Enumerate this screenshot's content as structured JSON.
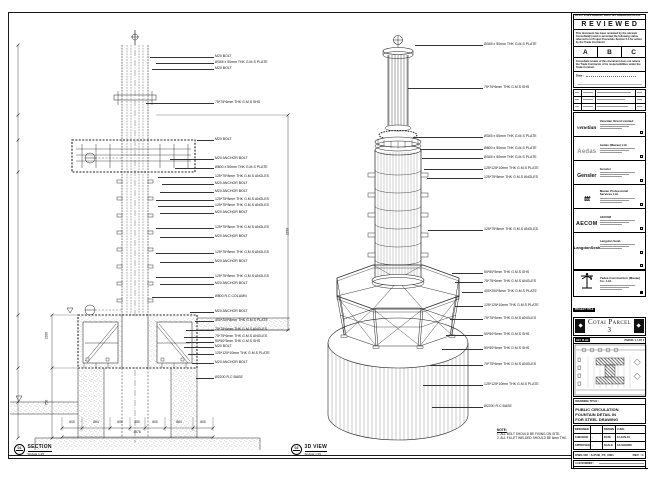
{
  "stamp": {
    "strip": "DO NOT SCALE DRAWING. VERIFY ALL DIMENSIONS ON SITE.",
    "title": "REVIEWED",
    "para1": "This document has been reviewed by the relevant Consultant(s) and is accorded the following status referred to in Project Procedure Section 5.4 for action by the Trade Contractor.",
    "options": [
      "A",
      "B",
      "C"
    ],
    "para2": "Consultant review of this document does not relieve the Trade Contractor of its responsibilities under the Trade Contract.",
    "date_label": "Date :"
  },
  "consultants": [
    {
      "logo": "venetian",
      "cls": "lg-ven",
      "name": "Venetian Orient Limited"
    },
    {
      "logo": "Aedas",
      "cls": "lg-aedas",
      "name": "Aedas (Macau) Ltd."
    },
    {
      "logo": "Gensler",
      "cls": "lg-gensler",
      "name": "Gensler"
    },
    {
      "logo": "ttt",
      "cls": "lg-ttt",
      "name": "Macau Professional Services Ltd."
    },
    {
      "logo": "AECOM",
      "cls": "lg-aecom",
      "name": "AECOM"
    },
    {
      "logo": "LangdonSeah",
      "cls": "lg-ls",
      "name": "Langdon Seah"
    }
  ],
  "contractor": {
    "name": "Yadea Construction (Macau) Co., Ltd."
  },
  "project": {
    "tag": "PROJECT TITLE",
    "title": "Cotai Parcel 3"
  },
  "key_plan": {
    "label": "KEY PLAN",
    "sub": "PARCEL 1, LOT 2"
  },
  "drawing_title": {
    "label": "DRAWING TITLE :",
    "lines": [
      "PUBLIC CIRCULATION",
      "FOUNTAIN DETAIL IN",
      "FOR STEEL DRAWING"
    ]
  },
  "fields": {
    "rows": [
      {
        "a": "DESIGNED",
        "b": "",
        "c": "DRAWN",
        "d": "LUNG"
      },
      {
        "a": "CHECKED",
        "b": "-",
        "c": "DATE",
        "d": "14-JAN-10"
      },
      {
        "a": "APPROVED",
        "b": "-",
        "c": "SCALE",
        "d": "AS SHOWN"
      }
    ]
  },
  "dwg": {
    "label": "DWG NO :",
    "value": "S-PUB_FS_0001",
    "rev_label": "REV :",
    "rev": "C"
  },
  "cad_rows": [
    {
      "l": "CAD NUMBER :",
      "v": ""
    },
    {
      "l": "CAD FILE NAME :",
      "v": "S-PUB_FS_0001.dwg"
    },
    {
      "l": "REFERENCE :",
      "v": ""
    }
  ],
  "notes": {
    "title": "NOTE:",
    "items": [
      "1. ALL BOLT SHOULD BE FIXING ON SITE.",
      "2. ALL FILLET WELDED SHOULD BE 6mm THK."
    ]
  },
  "views": [
    {
      "num": "01",
      "name": "SECTION",
      "scale": "SCALE 1:25",
      "x": 14,
      "y": 444
    },
    {
      "num": "02",
      "name": "3D VIEW",
      "scale": "SCALE 1:25",
      "x": 291,
      "y": 444
    }
  ],
  "section_labels": [
    {
      "t": "M20 BOLT",
      "x": 214,
      "y": 57,
      "a": 150
    },
    {
      "t": "Ø345 x 50mm THK G.M.S PLATE",
      "x": 214,
      "y": 63,
      "a": 156
    },
    {
      "t": "M20 BOLT",
      "x": 214,
      "y": 69,
      "a": 152
    },
    {
      "t": "75*75*6mm THK G.M.S SHS",
      "x": 214,
      "y": 103,
      "a": 146
    },
    {
      "t": "M20 BOLT",
      "x": 214,
      "y": 140,
      "a": 197
    },
    {
      "t": "M20 ANCHOR BOLT",
      "x": 214,
      "y": 159,
      "a": 170
    },
    {
      "t": "Ø800 x 50mm THK G.M.S PLATE",
      "x": 214,
      "y": 168,
      "a": 175
    },
    {
      "t": "125*75*8mm THK G.M.S ANGLES",
      "x": 214,
      "y": 177,
      "a": 158
    },
    {
      "t": "M20 ANCHOR BOLT",
      "x": 214,
      "y": 184,
      "a": 162
    },
    {
      "t": "M20 ANCHOR BOLT",
      "x": 214,
      "y": 192,
      "a": 160
    },
    {
      "t": "125*75*8mm THK G.M.S ANGLES",
      "x": 214,
      "y": 200,
      "a": 156
    },
    {
      "t": "125*75*8mm THK G.M.S ANGLES",
      "x": 214,
      "y": 206,
      "a": 158
    },
    {
      "t": "M20 ANCHOR BOLT",
      "x": 214,
      "y": 213,
      "a": 160
    },
    {
      "t": "125*75*8mm THK G.M.S ANGLES",
      "x": 214,
      "y": 228,
      "a": 156
    },
    {
      "t": "M20 ANCHOR BOLT",
      "x": 214,
      "y": 237,
      "a": 160
    },
    {
      "t": "125*75*8mm THK G.M.S ANGLES",
      "x": 214,
      "y": 253,
      "a": 156
    },
    {
      "t": "M20 ANCHOR BOLT",
      "x": 214,
      "y": 262,
      "a": 160
    },
    {
      "t": "125*75*8mm THK G.M.S ANGLES",
      "x": 214,
      "y": 277,
      "a": 156
    },
    {
      "t": "M20 ANCHOR BOLT",
      "x": 214,
      "y": 284,
      "a": 160
    },
    {
      "t": "Ø800 R.C COLUMN",
      "x": 214,
      "y": 297,
      "a": 152
    },
    {
      "t": "M20 ANCHOR BOLT",
      "x": 214,
      "y": 312,
      "a": 190
    },
    {
      "t": "400*200*8mm THK G.M.S PLATE",
      "x": 214,
      "y": 321,
      "a": 195
    },
    {
      "t": "75*75*6mm THK G.M.S ANGLES",
      "x": 214,
      "y": 330,
      "a": 186
    },
    {
      "t": "75*75*6mm THK G.M.S ANGLES",
      "x": 214,
      "y": 337,
      "a": 184
    },
    {
      "t": "50*50*5mm THK G.M.S SHS",
      "x": 214,
      "y": 342,
      "a": 186
    },
    {
      "t": "M20 BOLT",
      "x": 214,
      "y": 347,
      "a": 184
    },
    {
      "t": "125*125*10mm THK G.M.S PLATE",
      "x": 214,
      "y": 354,
      "a": 188
    },
    {
      "t": "M20 ANCHOR BOLT",
      "x": 214,
      "y": 363,
      "a": 192
    },
    {
      "t": "Ø2200 R.C BASE",
      "x": 214,
      "y": 378,
      "a": 196
    }
  ],
  "iso_labels": [
    {
      "t": "Ø345 x 50mm THK G.M.S PLATE",
      "x": 483,
      "y": 45,
      "a": 415
    },
    {
      "t": "75*75*6mm THK G.M.S SHS",
      "x": 483,
      "y": 88,
      "a": 408
    },
    {
      "t": "Ø345 x 50mm THK G.M.S PLATE",
      "x": 483,
      "y": 137,
      "a": 413
    },
    {
      "t": "Ø800 x 50mm THK G.M.S PLATE",
      "x": 483,
      "y": 149,
      "a": 420
    },
    {
      "t": "Ø345 x 50mm THK G.M.S PLATE",
      "x": 483,
      "y": 158,
      "a": 422
    },
    {
      "t": "125*125*10mm THK G.M.S PLATE",
      "x": 483,
      "y": 169,
      "a": 424
    },
    {
      "t": "125*75*8mm THK G.M.S ANGLES",
      "x": 483,
      "y": 178,
      "a": 427
    },
    {
      "t": "125*75*8mm THK G.M.S ANGLES",
      "x": 483,
      "y": 230,
      "a": 428
    },
    {
      "t": "50*50*5mm THK G.M.S SHS",
      "x": 483,
      "y": 273,
      "a": 452
    },
    {
      "t": "75*75*6mm THK G.M.S ANGLES",
      "x": 483,
      "y": 282,
      "a": 455
    },
    {
      "t": "400*200*8mm THK G.M.S PLATE",
      "x": 483,
      "y": 292,
      "a": 462
    },
    {
      "t": "125*125*10mm THK G.M.S PLATE",
      "x": 483,
      "y": 306,
      "a": 455
    },
    {
      "t": "75*75*6mm THK G.M.S ANGLES",
      "x": 483,
      "y": 319,
      "a": 450
    },
    {
      "t": "50*50*5mm THK G.M.S SHS",
      "x": 483,
      "y": 335,
      "a": 446
    },
    {
      "t": "50*50*5mm THK G.M.S SHS",
      "x": 483,
      "y": 349,
      "a": 442
    },
    {
      "t": "75*75*6mm THK G.M.S ANGLES",
      "x": 483,
      "y": 365,
      "a": 430
    },
    {
      "t": "125*125*10mm THK G.M.S PLATE",
      "x": 483,
      "y": 385,
      "a": 423
    },
    {
      "t": "Ø2200 R.C BASE",
      "x": 483,
      "y": 407,
      "a": 432
    }
  ],
  "dims_bottom": [
    {
      "t": "600",
      "x": 72,
      "y": 421
    },
    {
      "t": "864",
      "x": 96,
      "y": 421
    },
    {
      "t": "600",
      "x": 120,
      "y": 421
    },
    {
      "t": "450",
      "x": 137,
      "y": 421
    },
    {
      "t": "600",
      "x": 155,
      "y": 421
    },
    {
      "t": "864",
      "x": 179,
      "y": 421
    },
    {
      "t": "600",
      "x": 203,
      "y": 421
    },
    {
      "t": "4578",
      "x": 137,
      "y": 431
    }
  ],
  "dims_rot": [
    {
      "t": "1500",
      "x": 49,
      "y": 336
    },
    {
      "t": "750",
      "x": 49,
      "y": 402
    },
    {
      "t": "2250",
      "x": 290,
      "y": 232
    }
  ]
}
